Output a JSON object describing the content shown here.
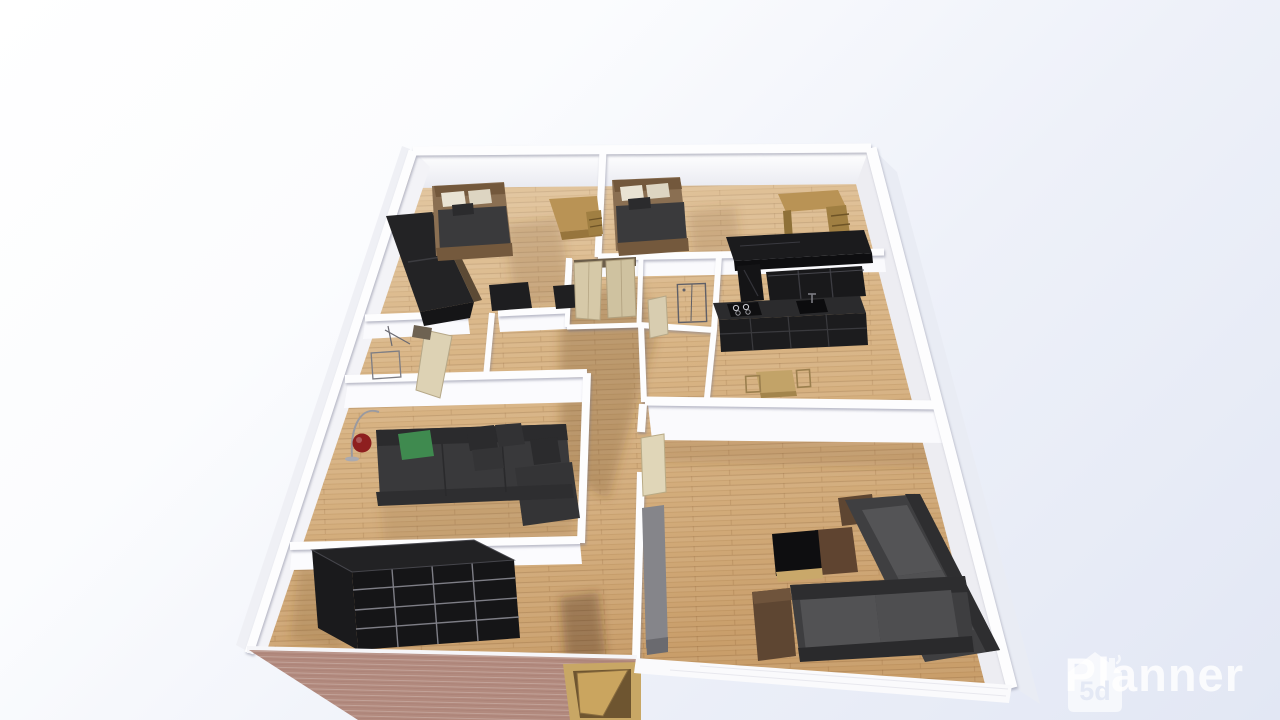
{
  "watermark": {
    "brand": "Planner",
    "logo_text": "5d"
  },
  "palette": {
    "background_top": "#ffffff",
    "background_bottom": "#e2e7f4",
    "wall_white": "#fbfbfd",
    "floor_wood": "#d4ac78",
    "brick_wall": "#b28a7e",
    "dark_furniture": "#232325",
    "sofa_charcoal": "#39393b",
    "sofa_gray": "#4a4a4c",
    "desk_wood": "#b99355",
    "bed_frame_wood": "#8a6f52",
    "duvet_dark": "#3a3a3c",
    "pillow_green": "#3f8a4f",
    "lamp_red": "#8e1f1f",
    "door_beige": "#d6c9a8",
    "entrance_door_wood": "#c8a765"
  },
  "scene": {
    "type": "3d-floor-plan-render",
    "view": "elevated perspective, top-down angle",
    "rooms": [
      {
        "name": "bedroom-top-left",
        "furniture": [
          "double-bed",
          "wardrobe",
          "desk",
          "dresser"
        ]
      },
      {
        "name": "bedroom-top-middle",
        "furniture": [
          "double-bed",
          "desk-with-drawers"
        ]
      },
      {
        "name": "kitchen",
        "furniture": [
          "bar-counter",
          "tall-cabinet",
          "wall-cabinets",
          "base-cabinets-stove-sink",
          "dining-table",
          "chairs"
        ]
      },
      {
        "name": "bathroom-left",
        "furniture": [
          "shower",
          "open-door"
        ]
      },
      {
        "name": "closet-center",
        "furniture": [
          "double-door-wardrobe"
        ]
      },
      {
        "name": "shower-room-center",
        "furniture": [
          "shower-cabin",
          "door"
        ]
      },
      {
        "name": "living-room-left",
        "furniture": [
          "corner-sofa",
          "green-pillow",
          "red-floor-lamp"
        ]
      },
      {
        "name": "storage-room-bottom-left",
        "furniture": [
          "black-cube-shelf"
        ]
      },
      {
        "name": "living-room-right",
        "furniture": [
          "wall-sofa",
          "bottom-sofa",
          "coffee-table",
          "sideboard",
          "open-door"
        ]
      },
      {
        "name": "entrance",
        "furniture": [
          "front-door-in-brick-wall"
        ]
      }
    ]
  }
}
